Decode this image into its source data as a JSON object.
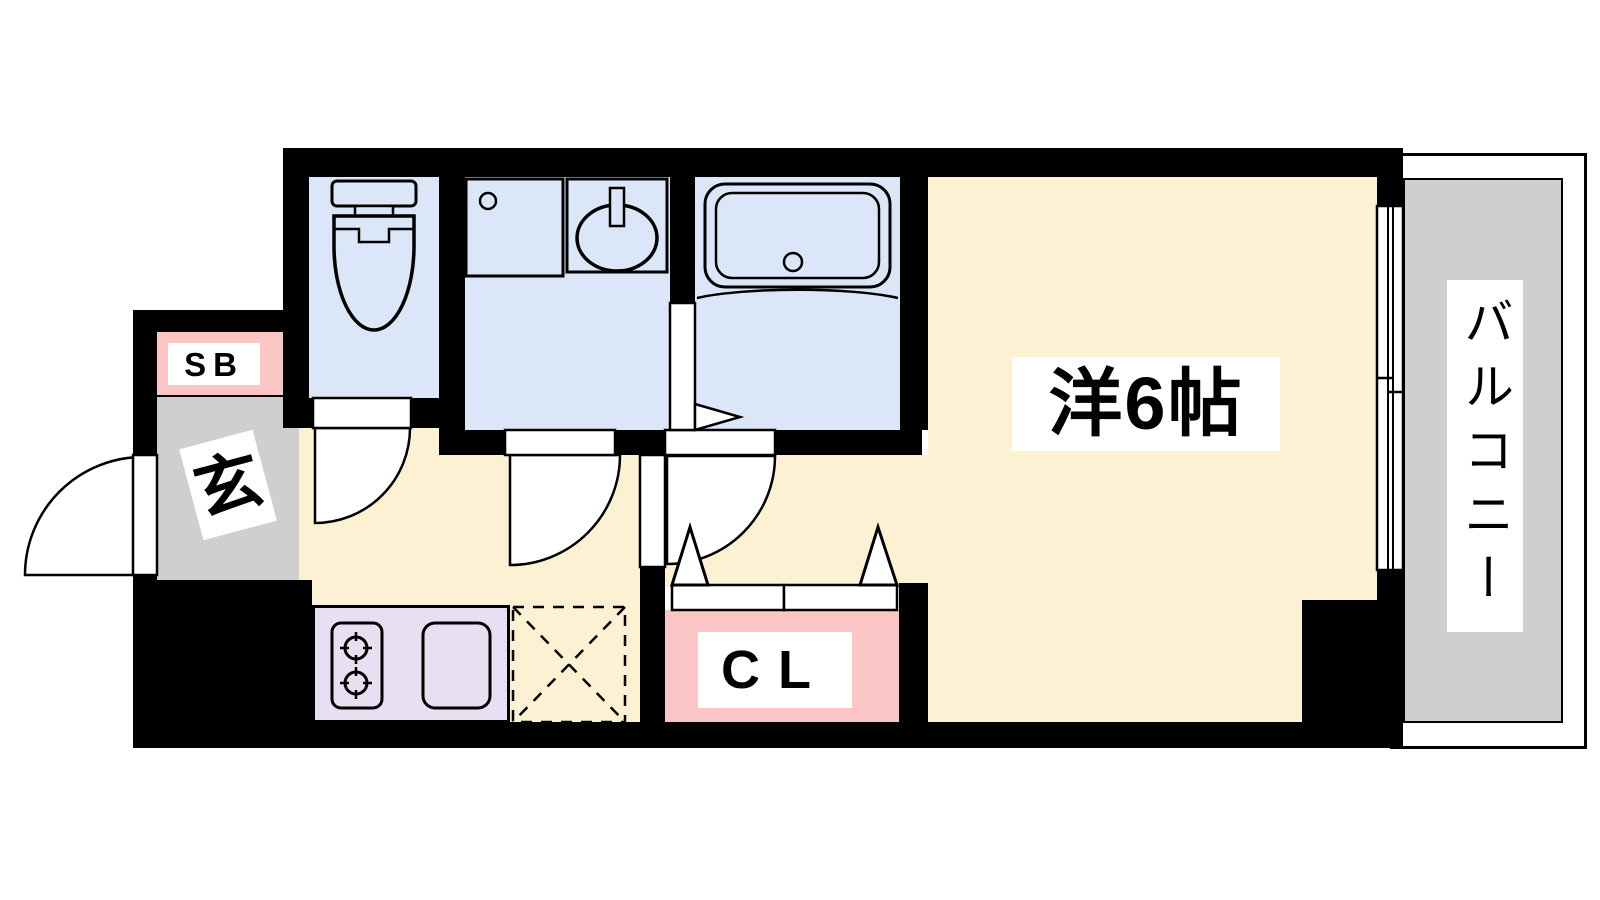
{
  "floorplan": {
    "type": "apartment-1K-floor-plan",
    "labels": {
      "main_room": "洋6帖",
      "balcony": "バルコニー",
      "entrance": "玄",
      "shoe_box": "SB",
      "closet": "CL"
    },
    "colors": {
      "wall": "#000000",
      "room_floor": "#FCF1D2",
      "wet_area": "#DBE7F8",
      "service_gray": "#CFCFCF",
      "storage_pink": "#FBC5C5",
      "kitchen_counter": "#E8DFF3",
      "label_bg": "#FFFFFF",
      "line": "#000000"
    },
    "fixtures": [
      "toilet-icon",
      "vanity-counter-icon",
      "washbasin-icon",
      "bathtub-icon",
      "gas-stove-icon",
      "kitchen-sink-icon",
      "washer-space-icon",
      "sliding-window-icon",
      "entrance-swing-door-icon",
      "toilet-swing-door-icon",
      "washroom-swing-door-icon",
      "room-swing-door-icon",
      "bath-folding-door-icon",
      "closet-folding-doors-icon"
    ]
  }
}
